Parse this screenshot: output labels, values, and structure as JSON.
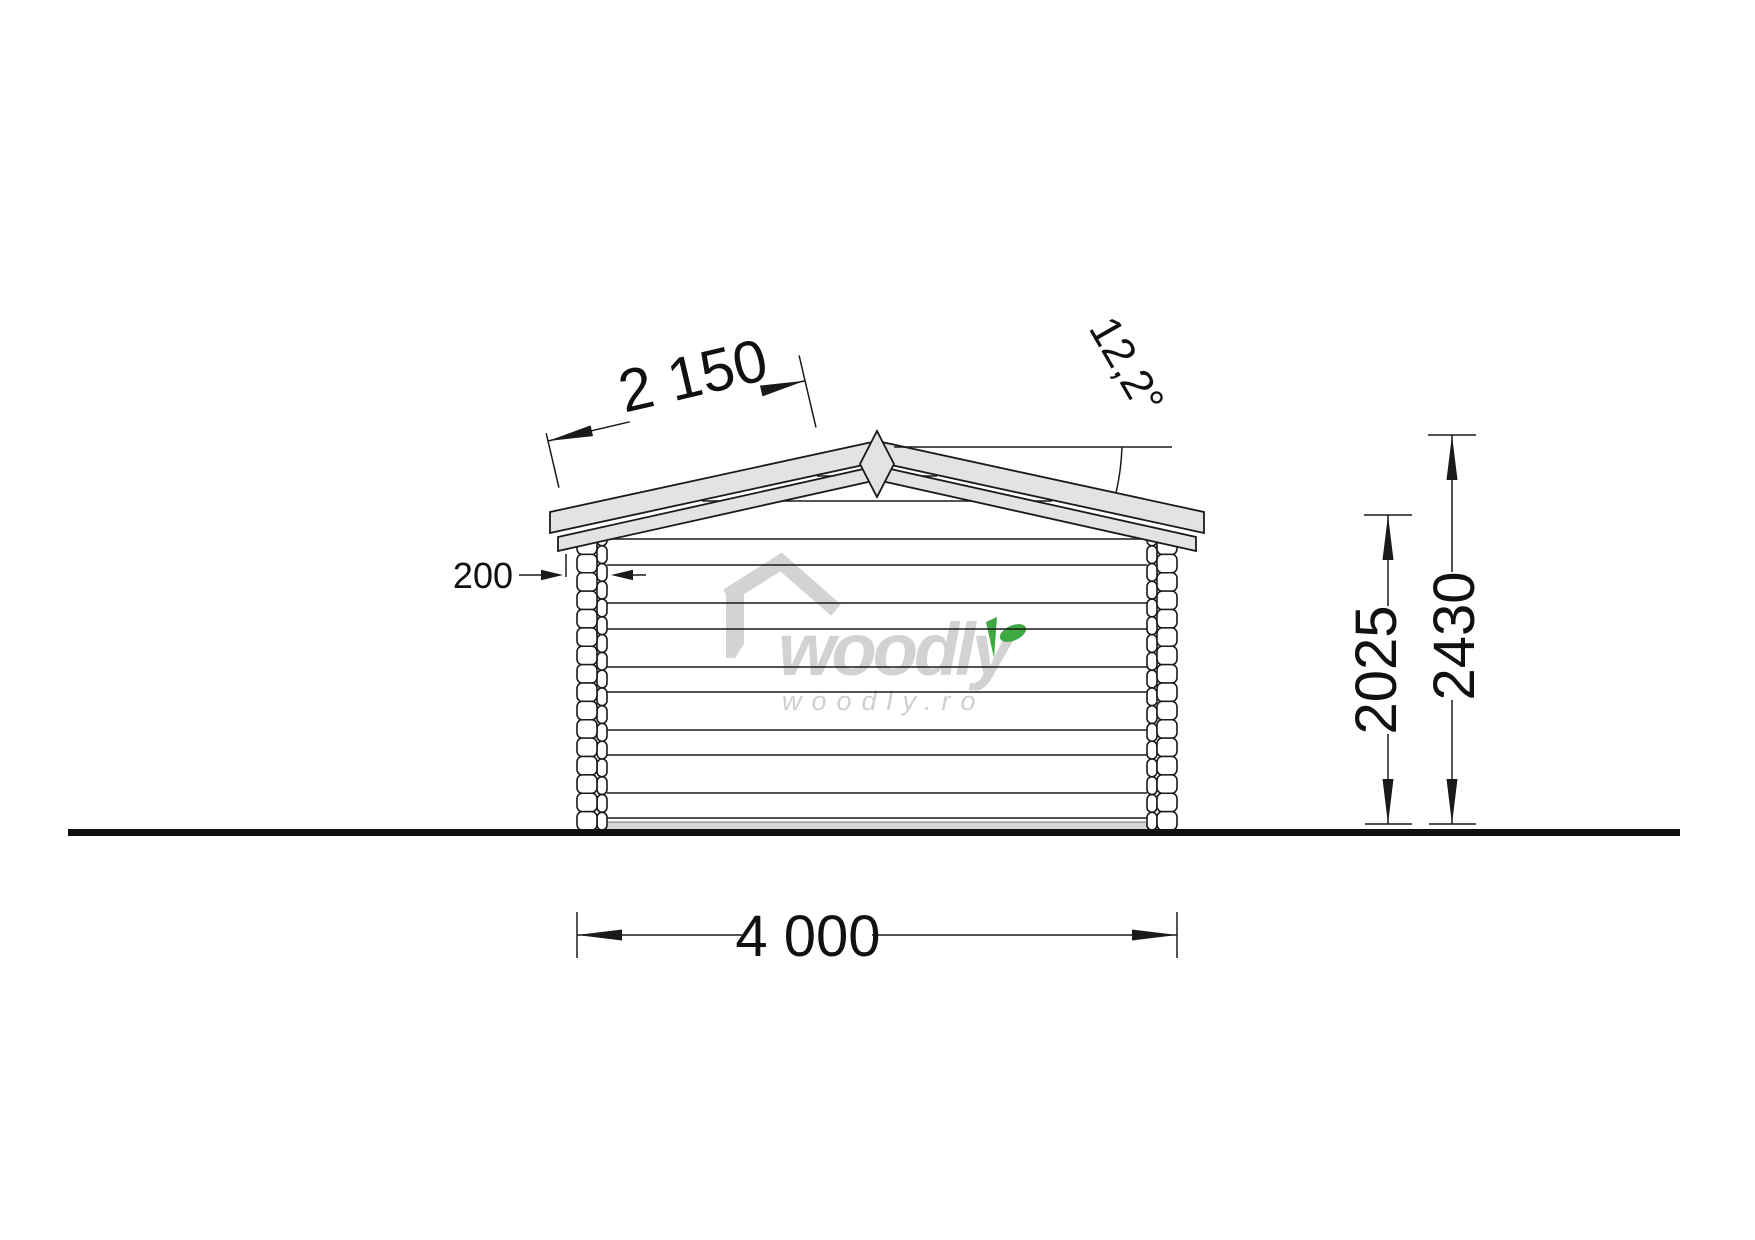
{
  "dims": {
    "roof_slope_length": "2 150",
    "roof_angle": "12,2°",
    "log_thickness": "200",
    "wall_height": "2025",
    "total_height": "2430",
    "building_width": "4 000"
  },
  "watermark": {
    "brand": "woodly",
    "url": "woodly.ro"
  },
  "colors": {
    "roof_fill": "#e3e3e3",
    "line": "#1a1a1a",
    "watermark_gray": "#d2d2d2",
    "leaf_green": "#3EA843",
    "foundation_gray": "#d6d6d6",
    "ground_black": "#111111"
  }
}
